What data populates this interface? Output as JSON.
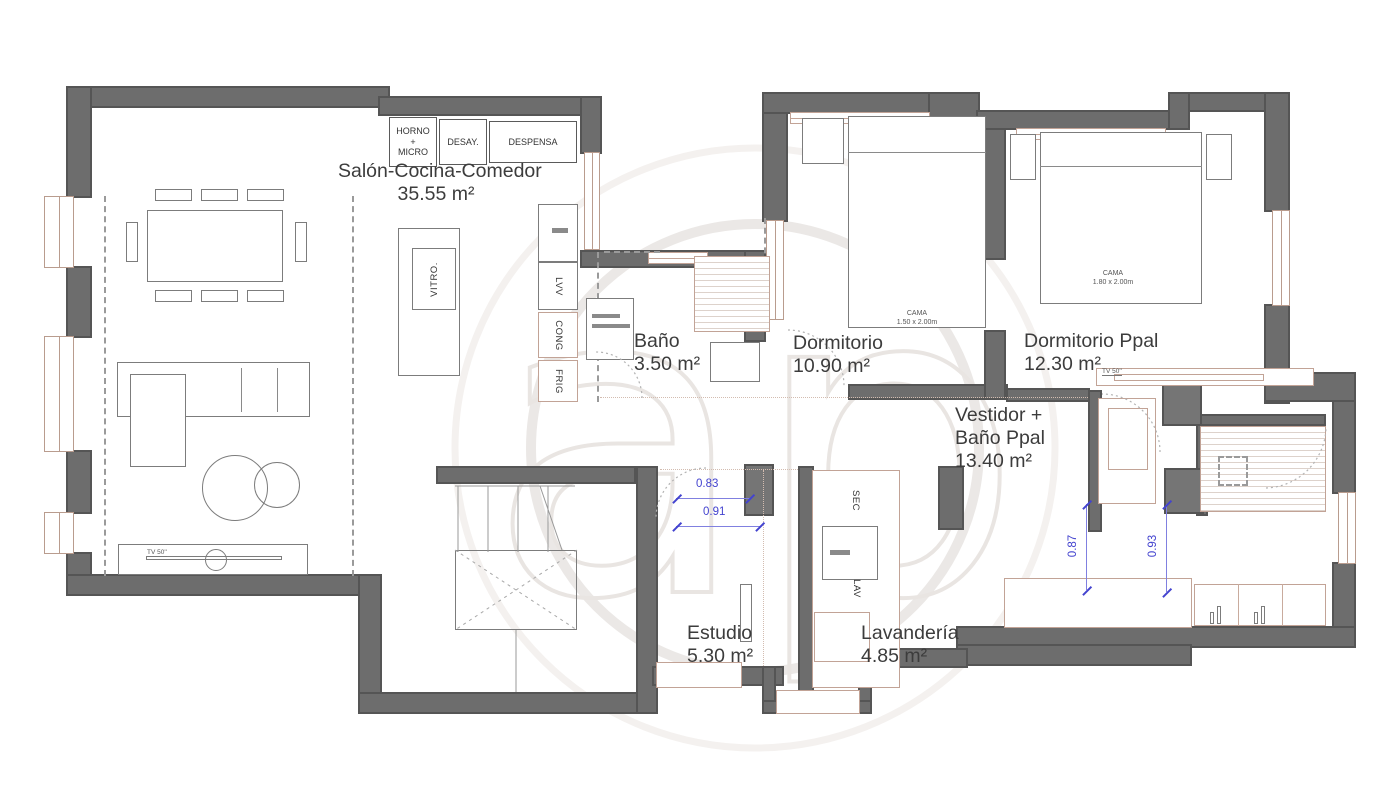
{
  "watermark": {
    "letters": "ap"
  },
  "colors": {
    "wall": "#6d6d6d",
    "fixture_outline": "#c2a396",
    "furniture_outline": "#7c7c7c",
    "dimension_blue": "#4343cf",
    "label_text": "#3c3c3c",
    "watermark_gray": "#eae7e5"
  },
  "rooms": {
    "salon": {
      "name": "Salón-Cocina-Comedor",
      "area": "35.55 m²"
    },
    "bano": {
      "name": "Baño",
      "area": "3.50 m²"
    },
    "dormitorio": {
      "name": "Dormitorio",
      "area": "10.90 m²"
    },
    "dorm_ppal": {
      "name": "Dormitorio Ppal",
      "area": "12.30 m²"
    },
    "vestidor": {
      "name_line1": "Vestidor +",
      "name_line2": "Baño Ppal",
      "area": "13.40 m²"
    },
    "estudio": {
      "name": "Estudio",
      "area": "5.30 m²"
    },
    "lavanderia": {
      "name": "Lavandería",
      "area": "4.85 m²"
    }
  },
  "kitchen": {
    "horno_l1": "HORNO",
    "horno_l2": "+",
    "horno_l3": "MICRO",
    "desay": "DESAY.",
    "despensa": "DESPENSA",
    "vitro": "VITRO.",
    "lvv": "LVV",
    "cong": "CONG",
    "frig": "FRIG"
  },
  "laundry": {
    "sec": "SEC",
    "lav": "LAV"
  },
  "beds": {
    "cama1_name": "CAMA",
    "cama1_size": "1.50 x 2.00m",
    "cama2_name": "CAMA",
    "cama2_size": "1.80 x 2.00m"
  },
  "tv": {
    "living": "TV 50''",
    "bedroom": "TV 50''"
  },
  "dimensions": {
    "hall_top": "0.83",
    "hall_bottom": "0.91",
    "vestidor_left": "0.87",
    "vestidor_right": "0.93"
  }
}
